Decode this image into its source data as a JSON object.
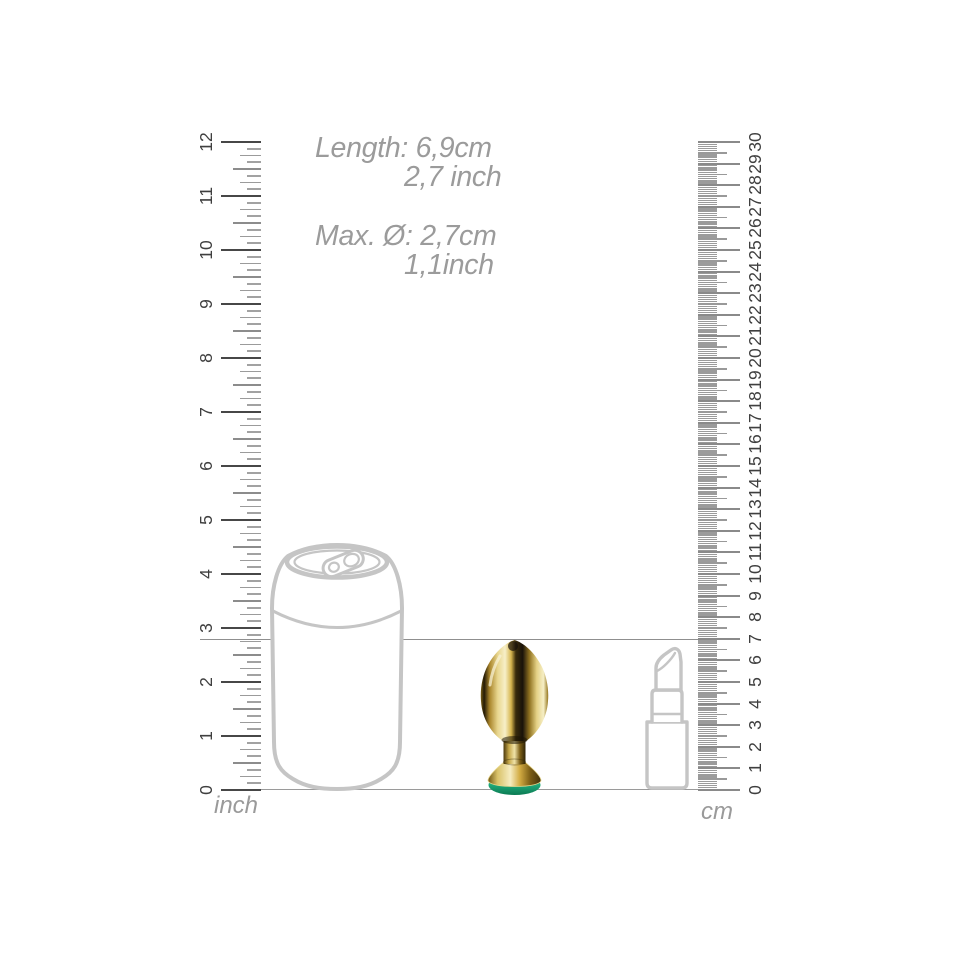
{
  "dimensions": {
    "length_line1": "Length: 6,9cm",
    "length_line2": "2,7 inch",
    "diameter_line1": "Max. Ø: 2,7cm",
    "diameter_line2": "1,1inch"
  },
  "rulers": {
    "inch": {
      "unit_label": "inch",
      "min": 0,
      "max": 12,
      "labels": [
        "0",
        "1",
        "2",
        "3",
        "4",
        "5",
        "6",
        "7",
        "8",
        "9",
        "10",
        "11",
        "12"
      ]
    },
    "cm": {
      "unit_label": "cm",
      "min": 0,
      "max": 30,
      "labels": [
        "0",
        "1",
        "2",
        "3",
        "4",
        "5",
        "6",
        "7",
        "8",
        "9",
        "10",
        "11",
        "12",
        "13",
        "14",
        "15",
        "16",
        "17",
        "18",
        "19",
        "20",
        "21",
        "22",
        "23",
        "24",
        "25",
        "26",
        "27",
        "28",
        "29",
        "30"
      ]
    }
  },
  "reference_line_cm": 7,
  "scale_objects": [
    "soda-can",
    "lipstick"
  ],
  "product": {
    "name": "gold-metal-plug-with-green-gem",
    "gem_color": "#1fa878",
    "metal_color": "#d9b84e"
  },
  "colors": {
    "text_gray": "#9b9b9b",
    "ruler_number": "#3f3f3f",
    "tick_major": "#474747",
    "tick_minor": "#9b9b9b",
    "outline_gray": "#c5c5c5",
    "line_gray": "#8f8f8f",
    "background": "#ffffff"
  }
}
